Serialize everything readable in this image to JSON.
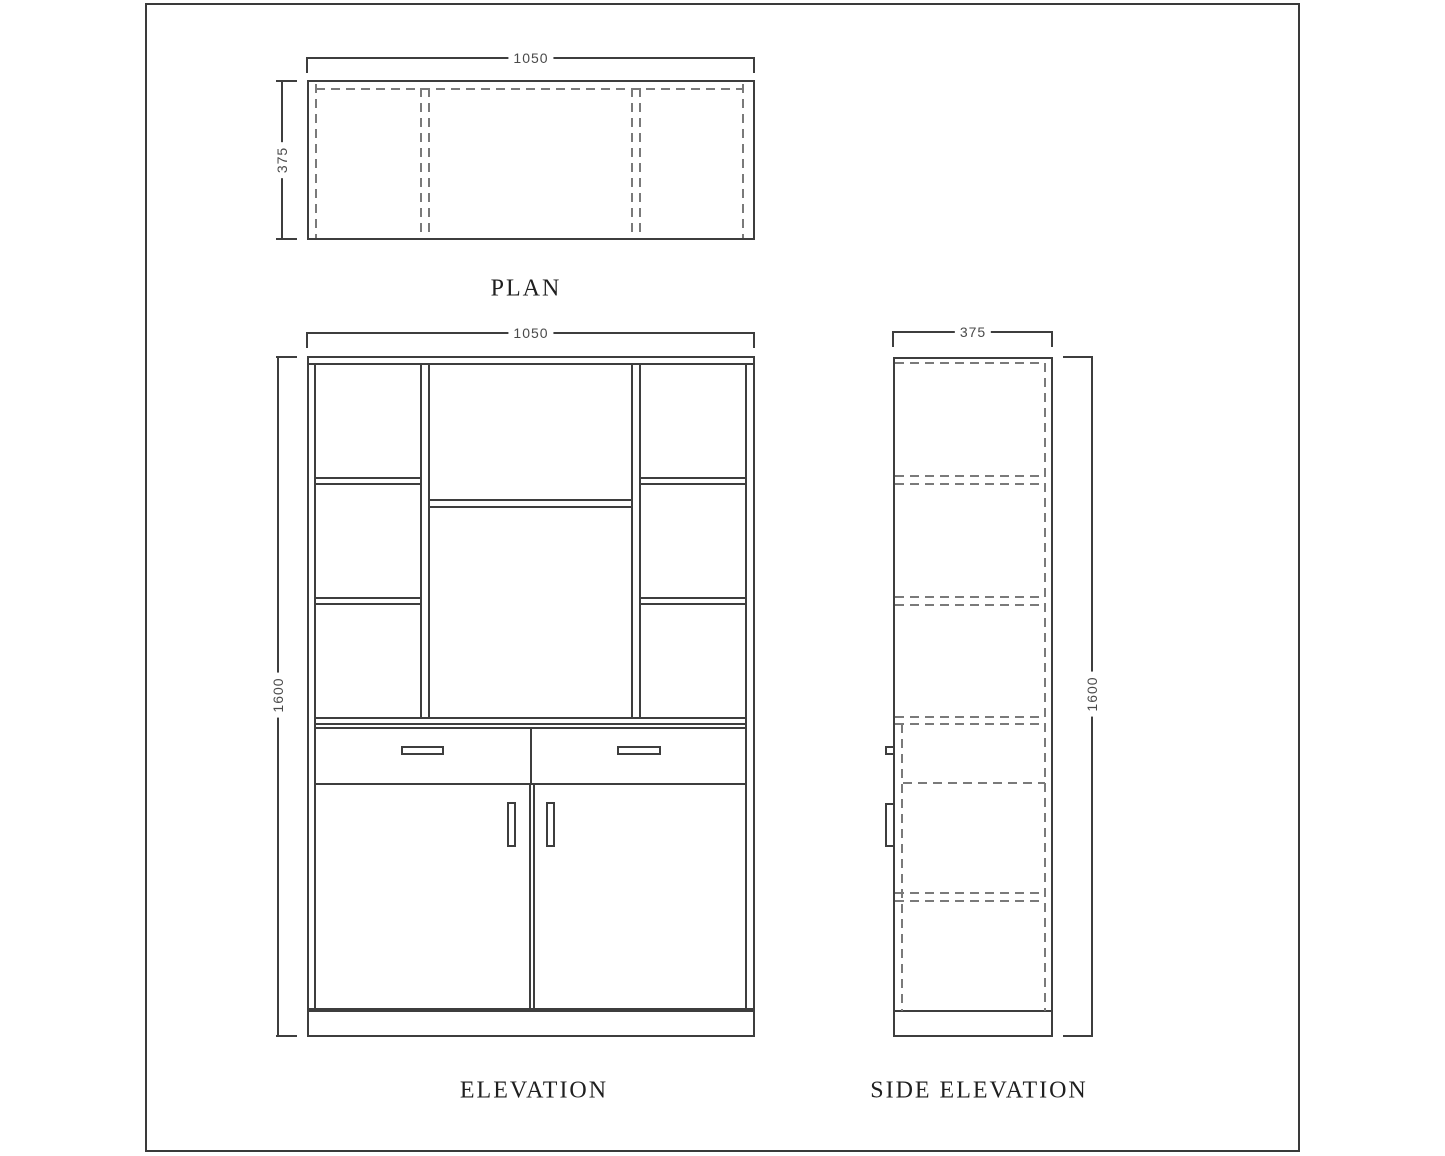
{
  "drawing": {
    "views": {
      "plan": {
        "title": "PLAN",
        "dims": {
          "width": "1050",
          "depth": "375"
        }
      },
      "elevation": {
        "title": "ELEVATION",
        "dims": {
          "width": "1050",
          "height": "1600"
        }
      },
      "side_elevation": {
        "title": "SIDE ELEVATION",
        "dims": {
          "depth": "375",
          "height": "1600"
        }
      }
    },
    "colors": {
      "background": "#ffffff",
      "solid_line": "#3e3e3e",
      "dashed_line": "#7a7a7a",
      "dimension_text": "#4a4a4a",
      "title_text": "#1f1f1f"
    }
  }
}
